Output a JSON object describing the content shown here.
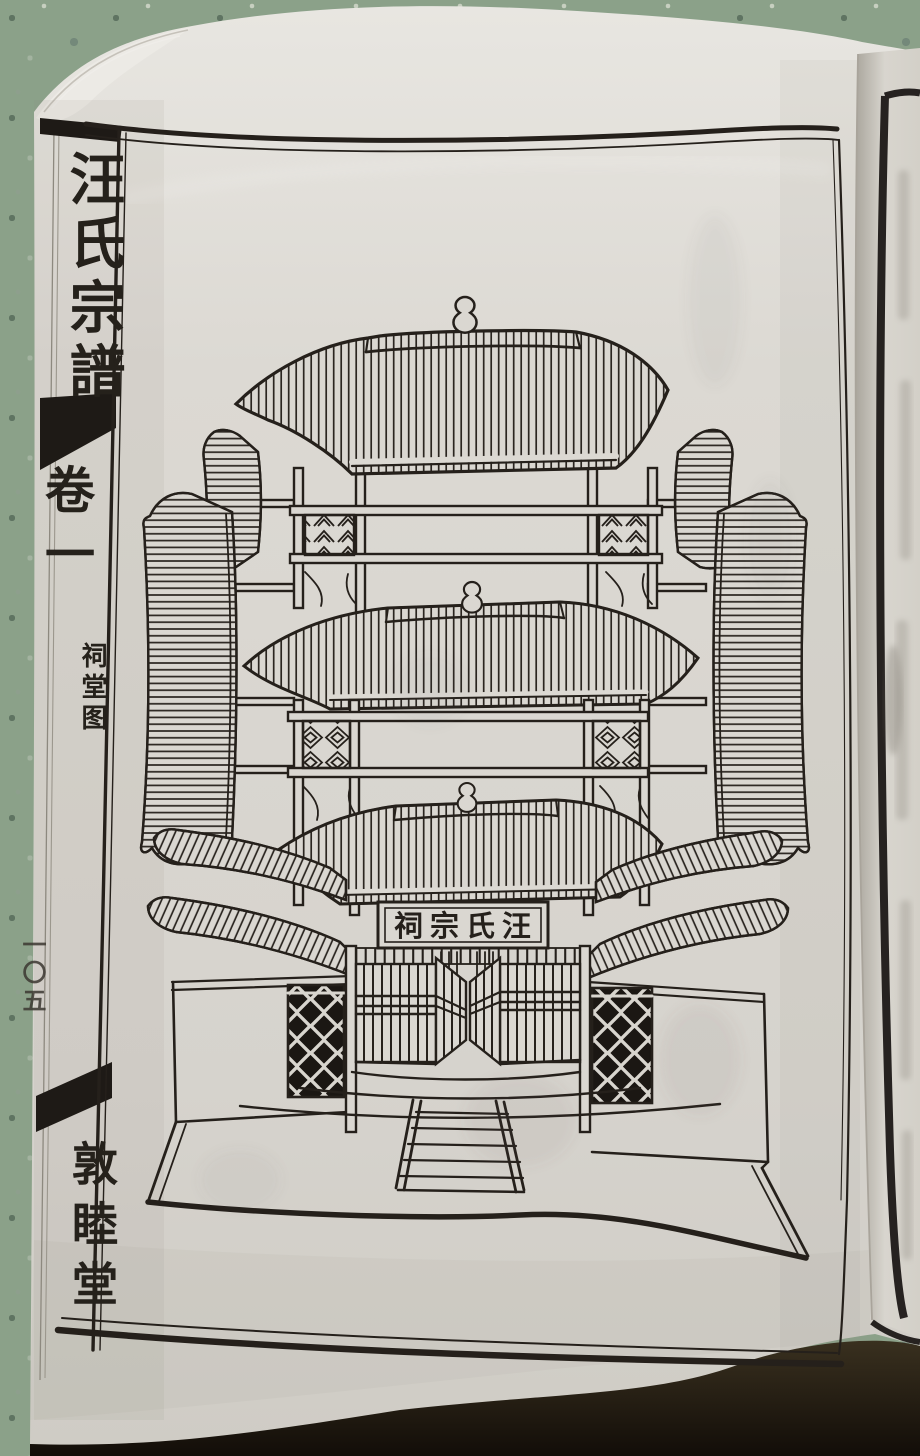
{
  "book_page": {
    "spine": {
      "title": "汪氏宗譜",
      "volume_label": "卷一",
      "section_caption": "祠堂图",
      "leaf_number": "一〇五",
      "hall_name": "敦睦堂"
    },
    "illustration": {
      "plaque_text": "祠宗氏汪"
    },
    "colors": {
      "paper": "#dad7d1",
      "paper_light": "#e7e5e0",
      "ink": "#25201b",
      "terrazzo_base": "#8ba189",
      "table_shadow": "#20180f",
      "next_page_paper": "#d8d5ce"
    }
  }
}
